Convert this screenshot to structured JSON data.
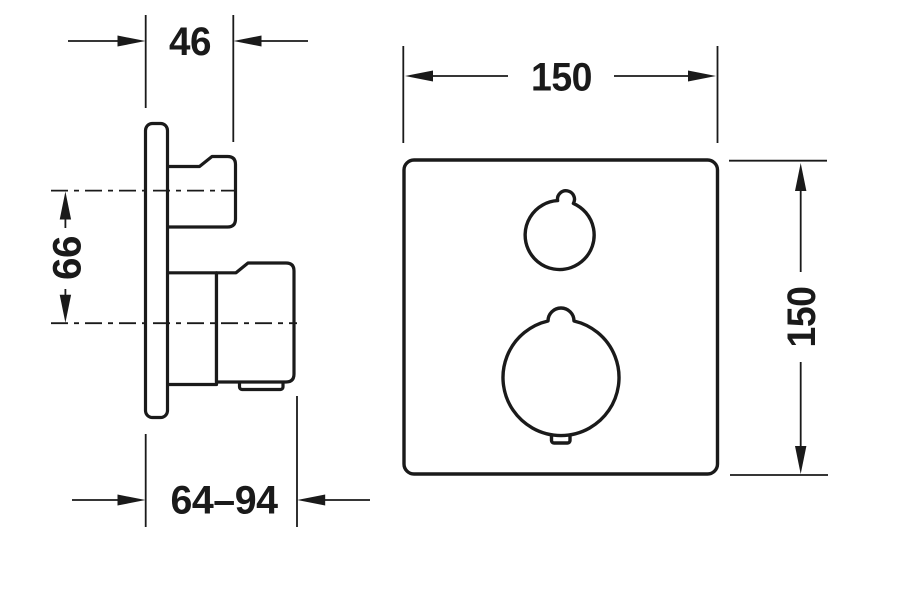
{
  "page": {
    "background_color": "#ffffff",
    "line_color": "#1a1a1a",
    "description_labels": {
      "drawing_type": "technical dimension drawing"
    }
  },
  "side_view": {
    "dims": {
      "plate_depth": "46",
      "handle_spacing": "66",
      "install_depth_range": "64–94"
    }
  },
  "front_view": {
    "dims": {
      "plate_width": "150",
      "plate_height": "150"
    }
  }
}
